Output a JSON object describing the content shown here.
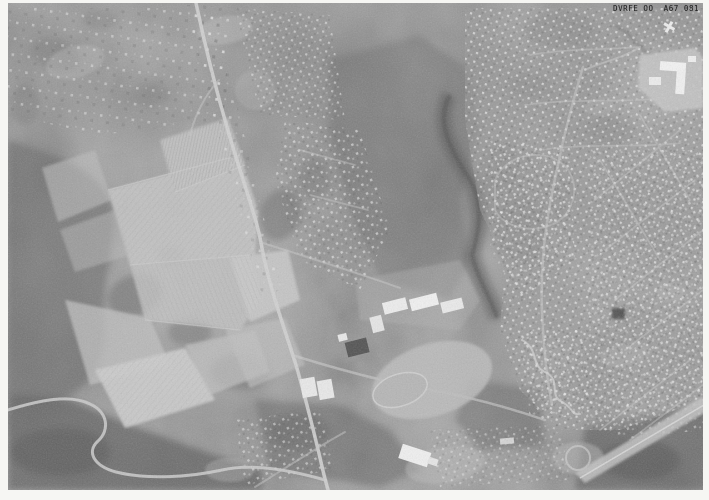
{
  "photo": {
    "frame_id_label": "DVRFE OO  A67 081",
    "colors": {
      "paper_white": "#f6f6f3",
      "photo_base_gray": "#929292",
      "field_light_gray": "#c6c6c6",
      "woodland_dark_gray": "#636363",
      "road_light_gray": "#d0d0d0",
      "label_ink": "#181818"
    }
  }
}
